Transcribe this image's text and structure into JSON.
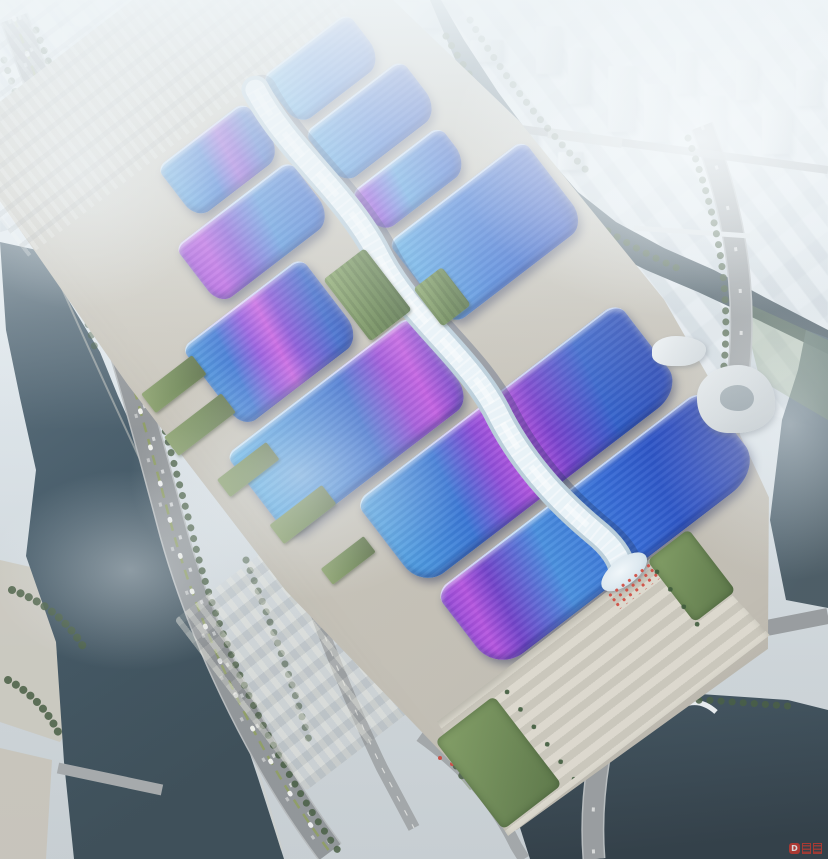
{
  "scene": {
    "description": "Aerial rendering of a riverside exhibition and convention center: paired wavy blue roof halls with sweeping purple ribbon stripes, a white quilted central concourse spine, grand stepped south plaza with palms, elevated expressway and rivers, hazy white city beyond",
    "watermark": {
      "badge_letter": "D"
    }
  },
  "palette": {
    "haze": "#eef3f6",
    "city": "#d4dbdf",
    "water": "#41586a",
    "water_dark": "#2e3f4b",
    "road": "#8d9194",
    "platform": "#c6c2b7",
    "plaza": "#d0ccc0",
    "green": "#5d7c44",
    "tree": "#3f5639",
    "roof_blue": "#2a66d4",
    "roof_deep": "#1c3cb0",
    "roof_cyan": "#54ace6",
    "purple": "#8a45dc",
    "magenta": "#c44fe0",
    "spine": "#e9f3f8",
    "watermark_red": "#c9382e"
  },
  "city": {
    "towers": [
      {
        "x": 118,
        "y": 2,
        "w": 64,
        "h": 30,
        "r": "16px 16px 4px 4px / 20px 20px 3px 3px"
      },
      {
        "x": 62,
        "y": 26,
        "w": 36,
        "h": 20
      },
      {
        "x": 208,
        "y": 6,
        "w": 34,
        "h": 22
      },
      {
        "x": 300,
        "y": 4,
        "w": 40,
        "h": 24
      },
      {
        "x": 352,
        "y": 22,
        "w": 30,
        "h": 20
      },
      {
        "x": 402,
        "y": 2,
        "w": 44,
        "h": 26
      },
      {
        "x": 470,
        "y": 40,
        "w": 34,
        "h": 22
      },
      {
        "x": 536,
        "y": 26,
        "w": 26,
        "h": 48
      },
      {
        "x": 568,
        "y": 48,
        "w": 22,
        "h": 56
      },
      {
        "x": 608,
        "y": 66,
        "w": 28,
        "h": 66
      },
      {
        "x": 644,
        "y": 84,
        "w": 24,
        "h": 58
      },
      {
        "x": 676,
        "y": 52,
        "w": 20,
        "h": 42
      },
      {
        "x": 700,
        "y": 96,
        "w": 26,
        "h": 54
      },
      {
        "x": 736,
        "y": 60,
        "w": 22,
        "h": 40
      },
      {
        "x": 762,
        "y": 110,
        "w": 30,
        "h": 44
      },
      {
        "x": 796,
        "y": 70,
        "w": 26,
        "h": 36
      },
      {
        "x": 508,
        "y": 130,
        "w": 30,
        "h": 20
      },
      {
        "x": 558,
        "y": 152,
        "w": 26,
        "h": 18
      }
    ]
  },
  "complex": {
    "halls": [
      {
        "id": "east-1",
        "x": 324,
        "y": 140,
        "w": 108,
        "h": 60,
        "bg": "linear-gradient(100deg,#58b2e8 0%,#2f74d8 45%,#2050c4 100%)"
      },
      {
        "id": "east-2",
        "x": 324,
        "y": 210,
        "w": 122,
        "h": 64,
        "bg": "linear-gradient(100deg,#4da4e4 0%,#2b66d2 50%,#1c42bc 100%)"
      },
      {
        "id": "east-3-small",
        "x": 324,
        "y": 286,
        "w": 112,
        "h": 50,
        "bg": "linear-gradient(100deg,#b44ce0 0%,#8448dc 14%,#4696e0 42%,#2a62d0 78%,#1e46bc 100%)"
      },
      {
        "id": "east-4",
        "x": 324,
        "y": 348,
        "w": 170,
        "h": 104,
        "bg": "linear-gradient(102deg,#54ace6 0%,#2e6ed6 42%,#1d44c0 88%,#16329f 100%)"
      },
      {
        "id": "west-1",
        "x": 186,
        "y": 148,
        "w": 110,
        "h": 64,
        "bg": "linear-gradient(100deg,#49a0e0 0%,#2e6ed4 38%,#8a4ad8 58%,#6f3fd0 66%,#2a5cc8 84%,#1e46b8 100%)"
      },
      {
        "id": "west-2",
        "x": 152,
        "y": 222,
        "w": 144,
        "h": 72,
        "bg": "linear-gradient(100deg,#9c44d8 0%,#b44ce0 18%,#7a45d4 34%,#3f86da 62%,#2758c8 100%)"
      },
      {
        "id": "west-3",
        "x": 96,
        "y": 306,
        "w": 150,
        "h": 100,
        "bg": "linear-gradient(100deg,#3f92dc 0%,#2d6cd2 22%,#8a45dc 40%,#c44fe0 52%,#7a3fd4 62%,#2456c6 86%,#1c3cb0 100%)"
      },
      {
        "id": "west-4",
        "x": 66,
        "y": 418,
        "w": 230,
        "h": 104,
        "bg": "linear-gradient(100deg,#52b0e8 0%,#3a86da 30%,#2c62cc 55%,#9a44d8 74%,#c050e0 84%,#8040cc 94%,#6636bf 100%)"
      },
      {
        "id": "south-1-fullwidth",
        "x": 140,
        "y": 534,
        "w": 330,
        "h": 108,
        "r": "14px 16px 34px 28px / 12px 14px 26px 30px",
        "bg": "linear-gradient(100deg,#4aa2e2 0%,#2f70d4 26%,#8c44d8 40%,#c04ee0 50%,#7438cc 60%,#2456c8 78%,#1a38ae 100%)"
      },
      {
        "id": "south-2-entrance",
        "x": 148,
        "y": 654,
        "w": 336,
        "h": 100,
        "r": "16px 18px 40px 34px / 14px 16px 30px 34px",
        "bg": "linear-gradient(100deg,#8a3fd4 0%,#b24ade 8%,#6c38c8 16%,#3f8ade 34%,#2a62d4 58%,#1c3fbc 82%,#14289c 100%)"
      }
    ],
    "green_strips": [
      {
        "x": 250,
        "y": 338,
        "w": 52,
        "h": 78
      },
      {
        "x": 316,
        "y": 400,
        "w": 36,
        "h": 48
      }
    ],
    "sheds": [
      {
        "x": 36,
        "y": 318,
        "w": 64,
        "h": 24
      },
      {
        "x": 28,
        "y": 366,
        "w": 72,
        "h": 24
      },
      {
        "x": 44,
        "y": 432,
        "w": 62,
        "h": 22
      },
      {
        "x": 58,
        "y": 500,
        "w": 66,
        "h": 24
      },
      {
        "x": 72,
        "y": 566,
        "w": 54,
        "h": 20
      }
    ]
  }
}
